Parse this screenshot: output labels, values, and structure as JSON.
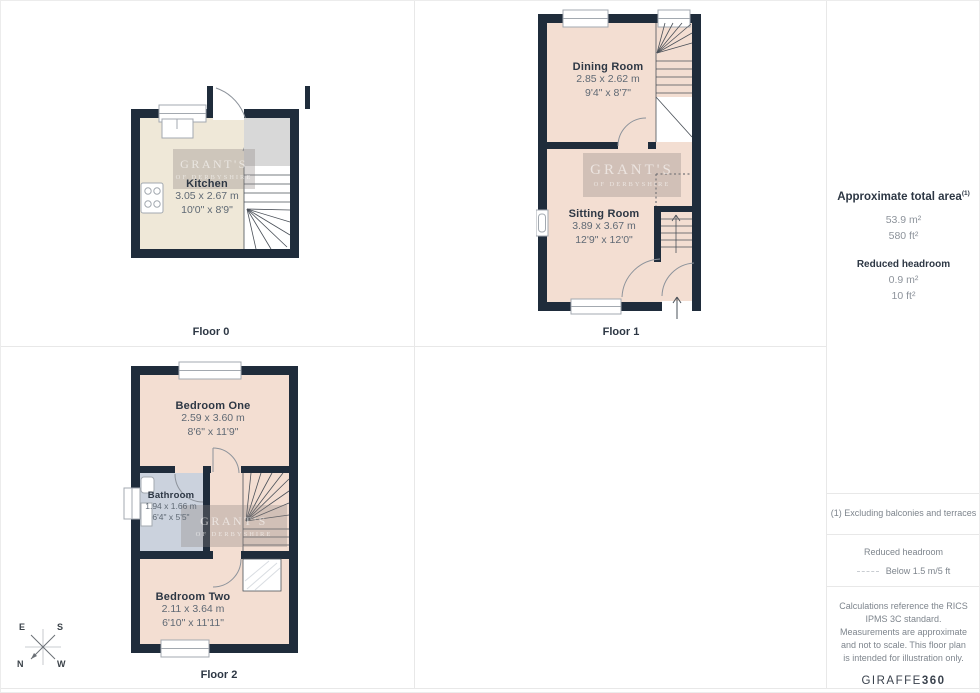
{
  "floors": [
    {
      "label": "Floor 0",
      "rooms": [
        {
          "name": "Kitchen",
          "dims_m": "3.05 x 2.67 m",
          "dims_ft": "10'0\" x 8'9\""
        }
      ]
    },
    {
      "label": "Floor 1",
      "rooms": [
        {
          "name": "Dining Room",
          "dims_m": "2.85 x 2.62 m",
          "dims_ft": "9'4\" x 8'7\""
        },
        {
          "name": "Sitting Room",
          "dims_m": "3.89 x 3.67 m",
          "dims_ft": "12'9\" x 12'0\""
        }
      ]
    },
    {
      "label": "Floor 2",
      "rooms": [
        {
          "name": "Bedroom One",
          "dims_m": "2.59 x 3.60 m",
          "dims_ft": "8'6\" x 11'9\""
        },
        {
          "name": "Bathroom",
          "dims_m": "1.94 x 1.66 m",
          "dims_ft": "6'4\" x 5'5\""
        },
        {
          "name": "Bedroom Two",
          "dims_m": "2.11 x 3.64 m",
          "dims_ft": "6'10\" x 11'11\""
        }
      ]
    }
  ],
  "watermark": {
    "line1": "GRANT'S",
    "line2": "OF DERBYSHIRE"
  },
  "sidebar": {
    "total_area_title": "Approximate total area",
    "total_area_superscript": "(1)",
    "total_area_m2": "53.9 m²",
    "total_area_ft2": "580 ft²",
    "reduced_headroom_title": "Reduced headroom",
    "reduced_headroom_m2": "0.9 m²",
    "reduced_headroom_ft2": "10 ft²",
    "footnote": "(1) Excluding balconies and terraces",
    "legend_title": "Reduced headroom",
    "legend_value": "Below 1.5 m/5 ft",
    "disclaimer": "Calculations reference the RICS IPMS 3C standard. Measurements are approximate and not to scale. This floor plan is intended for illustration only.",
    "brand_name": "GIRAFFE",
    "brand_suffix": "360"
  },
  "compass": {
    "n": "N",
    "e": "E",
    "s": "S",
    "w": "W"
  },
  "colors": {
    "wall": "#1f2c3b",
    "room_fill": "#f3ded2",
    "kitchen_fill": "#efe8d8",
    "bathroom_fill": "#cbd2dd",
    "landing_gray": "#d8d8d8",
    "grid_line": "#e8e8e8"
  }
}
